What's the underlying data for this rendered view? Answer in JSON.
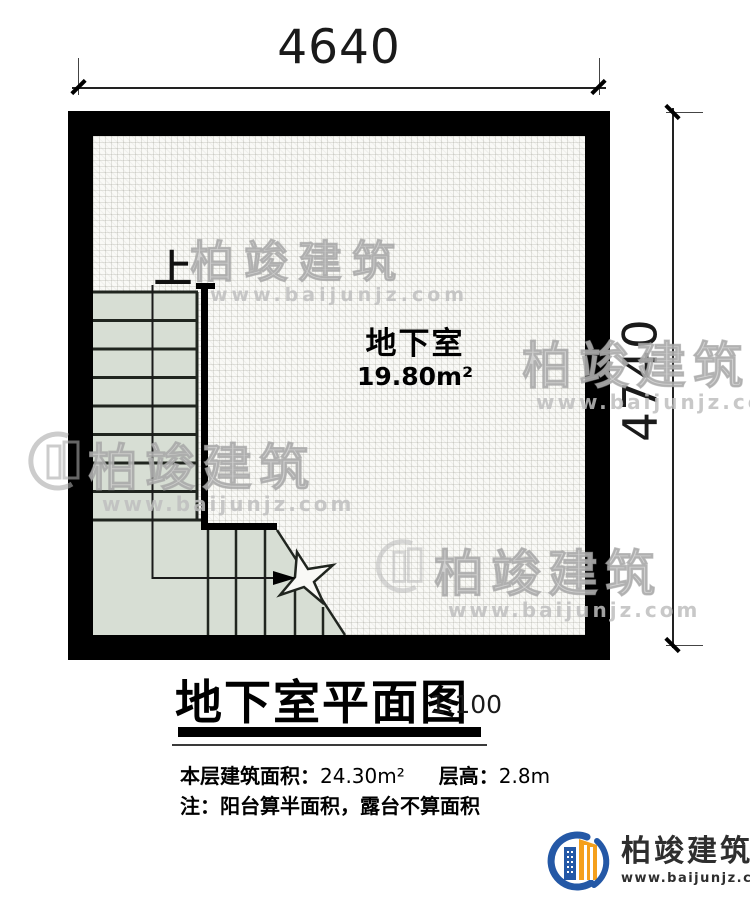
{
  "dimensions": {
    "top": "4640",
    "right": "4740"
  },
  "plan": {
    "room_label": "地下室",
    "room_area": "19.80m²",
    "stairs_up_label": "上"
  },
  "title_block": {
    "title": "地下室平面图",
    "scale": "1:100",
    "area_label": "本层建筑面积：",
    "area_value": "24.30m²",
    "floor_height_label": "层高：",
    "floor_height_value": "2.8m",
    "note": "注：阳台算半面积，露台不算面积"
  },
  "watermark": {
    "title": "柏竣建筑",
    "url": "www.baijunjz.com"
  },
  "logo": {
    "name": "柏竣建筑",
    "site": "www.baijunjz.com"
  },
  "colors": {
    "wall": "#000000",
    "stair_fill": "#d7ded4",
    "stair_line": "#20251f",
    "logo_blue": "#2458a6",
    "logo_orange": "#f5a01c"
  }
}
